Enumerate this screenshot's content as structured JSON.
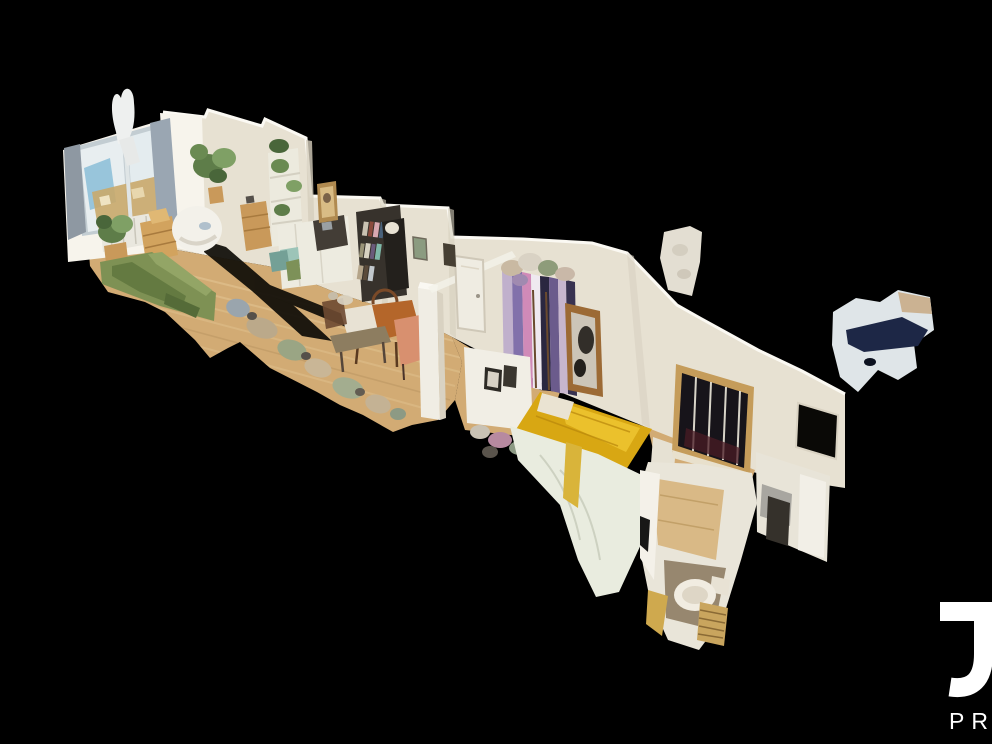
{
  "scene": {
    "type": "3d-dollhouse-apartment-scan",
    "view": "cutaway aerial view of an apartment point-cloud model on black background",
    "rooms": [
      "living room",
      "dining area",
      "bedroom",
      "bathroom"
    ]
  },
  "watermark": {
    "letter": "J",
    "partial_text": "PR"
  },
  "palette": {
    "background": "#000000",
    "wall": "#e7e1d2",
    "wall_bright": "#f7f4ec",
    "wall_shade": "#d6cebd",
    "floor": "#d2ab74",
    "floor_light": "#e3c795",
    "floor_shade": "#b08a5a",
    "sofa_green": "#7e9154",
    "bed_yellow": "#d8a713",
    "duvet_white": "#e9ecdf",
    "window_sky": "#8fc0d8",
    "wood_frame": "#c59c5a",
    "dark_pane": "#17141a",
    "shadow": "#0e0c07",
    "logo_white": "#ffffff"
  }
}
